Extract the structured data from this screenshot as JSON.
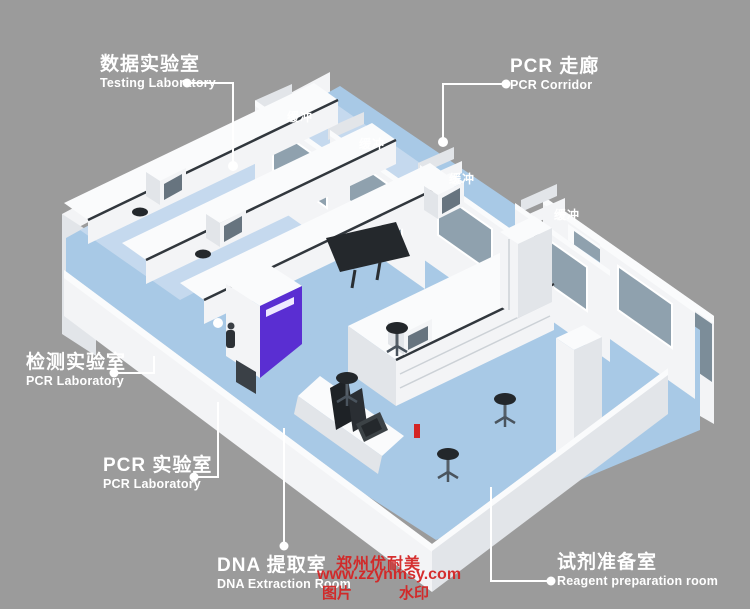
{
  "colors": {
    "bg": "#9b9b9b",
    "wall": "#f3f4f6",
    "wall-light": "#fafbfc",
    "wall-shade": "#e2e5e9",
    "wall-dark": "#ccd1d6",
    "floor": "#a8c9e6",
    "floor-light": "#cadcee",
    "window": "#8fa1ae",
    "window-dark": "#7c8d99",
    "purple": "#5a2ed2",
    "equip-dark": "#24282c",
    "screen": "#67747f",
    "red": "#d42525",
    "line": "#ffffff"
  },
  "callouts": [
    {
      "id": "testing-laboratory",
      "zh": "数据实验室",
      "en": "Testing Laboratory"
    },
    {
      "id": "pcr-corridor",
      "zh": "PCR 走廊",
      "en": "PCR Corridor"
    },
    {
      "id": "detection-laboratory",
      "zh": "检测实验室",
      "en": "PCR Laboratory"
    },
    {
      "id": "pcr-laboratory",
      "zh": "PCR 实验室",
      "en": "PCR Laboratory"
    },
    {
      "id": "dna-extraction-room",
      "zh": "DNA 提取室",
      "en": "DNA Extraction Room"
    },
    {
      "id": "reagent-preparation-room",
      "zh": "试剂准备室",
      "en": "Reagent preparation room"
    }
  ],
  "buffer_labels": [
    "缓冲",
    "缓冲",
    "缓冲",
    "缓冲"
  ],
  "watermark": {
    "company": "郑州优耐美",
    "url": "www.zzynmsy.com",
    "tag_left": "图片",
    "tag_right": "水印"
  }
}
